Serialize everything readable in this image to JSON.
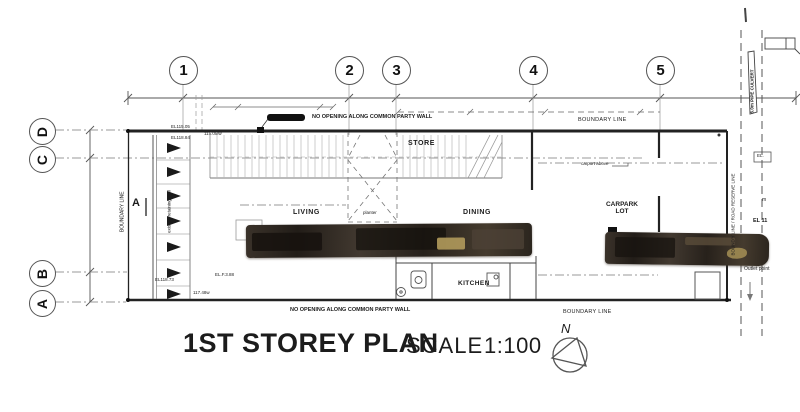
{
  "title": {
    "main": "1ST STOREY PLAN",
    "scale_label": "SCALE",
    "scale_value": "1:100"
  },
  "north": {
    "label": "N"
  },
  "grid": {
    "top": [
      "1",
      "2",
      "3",
      "4",
      "5"
    ],
    "left": [
      "D",
      "C",
      "B",
      "A"
    ]
  },
  "rooms": {
    "living": "LIVING",
    "planter": "planter",
    "dining": "DINING",
    "store": "STORE",
    "kitchen": "KITCHEN",
    "carpark_line1": "CARPARK",
    "carpark_line2": "LOT"
  },
  "annotations": {
    "boundary_top": "BOUNDARY LINE",
    "boundary_left": "BOUNDARY LINE",
    "boundary_bottom": "BOUNDARY LINE",
    "road_reserve": "BOUND'Y LINE / ROAD RESERVE LINE",
    "pipe_culvert": "6.0m PIPE CULVERT",
    "no_opening_top": "NO OPENING ALONG COMMON PARTY WALL",
    "no_opening_bottom": "NO OPENING ALONG COMMON PARTY WALL",
    "carport_above": "carport above",
    "retaining_wall": "existing retaining wall",
    "section_a": "A",
    "outlet_point": "Outlet point"
  },
  "levels": {
    "el1": "EL115.05",
    "el2": "EL118.84",
    "el3": "115.05lw",
    "el4": "EL118.73",
    "el5": "117.48w",
    "el6": "EL.F.3.88",
    "el7": "EL 11",
    "el8": "EL.",
    "el9": "m"
  },
  "colors": {
    "line": "#555555",
    "wall": "#222222",
    "redaction": "#2b241e",
    "redaction_light": "#ab9559"
  }
}
